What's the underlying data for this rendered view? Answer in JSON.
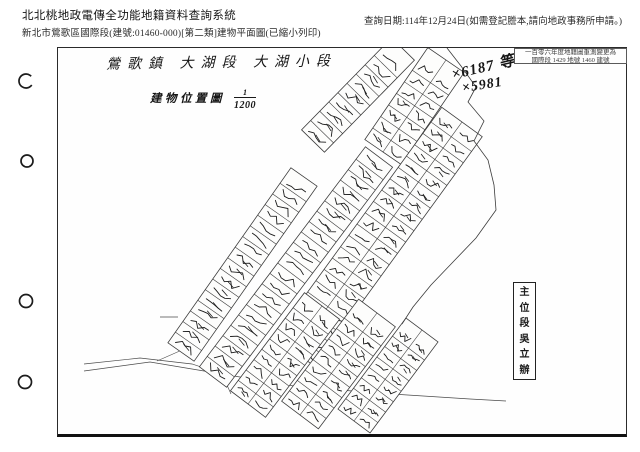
{
  "header": {
    "system_title": "北北桃地政電傳全功能地籍資料查詢系統",
    "doc_line": "新北市鶯歌區國際段(建號:01460-000)[第二類]建物平面圖(已縮小列印)",
    "query_date": "查詢日期:114年12月24日(如需登記謄本,請向地政事務所申請。)"
  },
  "map": {
    "hand_title": "鶯歌鎮 大湖段 大湖小段",
    "location_label": "建物位置圖",
    "scale": {
      "numerator": "1",
      "denominator": "1200"
    },
    "annotation_1": "×6187 等",
    "annotation_2": "×5981",
    "corner_stamp_line1": "一百零六年度地籍圖重測變更為",
    "corner_stamp_line2": "國際段 1429 地號 1460 建號",
    "side_stamp": "主\n位\n段\n吳\n立\n辦",
    "line_color": "#3b3b3b",
    "scribble_color": "#1c1c1c"
  },
  "geometry": {
    "frame": [
      57,
      47,
      570,
      390
    ],
    "strips": [
      {
        "a": [
          181,
          352
        ],
        "b": [
          304,
          177
        ],
        "w": 32,
        "rows": 1,
        "lot": 13
      },
      {
        "a": [
          313,
          141
        ],
        "b": [
          403,
          49
        ],
        "w": 32,
        "rows": 1,
        "lot": 13
      },
      {
        "a": [
          213,
          377
        ],
        "b": [
          379,
          157
        ],
        "w": 34,
        "rows": 1,
        "lot": 13
      },
      {
        "a": [
          383,
          152
        ],
        "b": [
          446,
          60
        ],
        "w": 44,
        "rows": 2,
        "lot": 14
      },
      {
        "a": [
          295,
          352
        ],
        "b": [
          462,
          122
        ],
        "w": 50,
        "rows": 2,
        "lot": 14
      },
      {
        "a": [
          248,
          404
        ],
        "b": [
          322,
          306
        ],
        "w": 44,
        "rows": 2,
        "lot": 13
      },
      {
        "a": [
          300,
          415
        ],
        "b": [
          377,
          313
        ],
        "w": 46,
        "rows": 2,
        "lot": 13
      },
      {
        "a": [
          354,
          421
        ],
        "b": [
          422,
          330
        ],
        "w": 40,
        "rows": 2,
        "lot": 13
      }
    ],
    "roads": [
      [
        [
          84,
          371
        ],
        [
          150,
          362
        ],
        [
          222,
          374
        ],
        [
          300,
          387
        ],
        [
          392,
          394
        ],
        [
          470,
          399
        ],
        [
          506,
          401
        ]
      ],
      [
        [
          84,
          364
        ],
        [
          140,
          358
        ],
        [
          192,
          364
        ],
        [
          222,
          374
        ]
      ],
      [
        [
          222,
          374
        ],
        [
          231,
          394
        ]
      ],
      [
        [
          160,
          317
        ],
        [
          178,
          317
        ]
      ],
      [
        [
          157,
          361
        ],
        [
          182,
          350
        ]
      ]
    ],
    "boundary": [
      [
        447,
        48
      ],
      [
        461,
        66
      ],
      [
        476,
        87
      ],
      [
        468,
        102
      ],
      [
        484,
        121
      ],
      [
        474,
        141
      ],
      [
        488,
        160
      ],
      [
        494,
        185
      ],
      [
        496,
        210
      ],
      [
        476,
        238
      ],
      [
        453,
        262
      ],
      [
        431,
        285
      ],
      [
        413,
        307
      ],
      [
        402,
        324
      ]
    ],
    "punch_marks": [
      {
        "x": 26,
        "y": 81,
        "r": 7,
        "open": true
      },
      {
        "x": 27,
        "y": 161,
        "r": 6,
        "open": false
      },
      {
        "x": 26,
        "y": 301,
        "r": 6.5,
        "open": false
      },
      {
        "x": 25,
        "y": 382,
        "r": 6.5,
        "open": false
      }
    ]
  }
}
